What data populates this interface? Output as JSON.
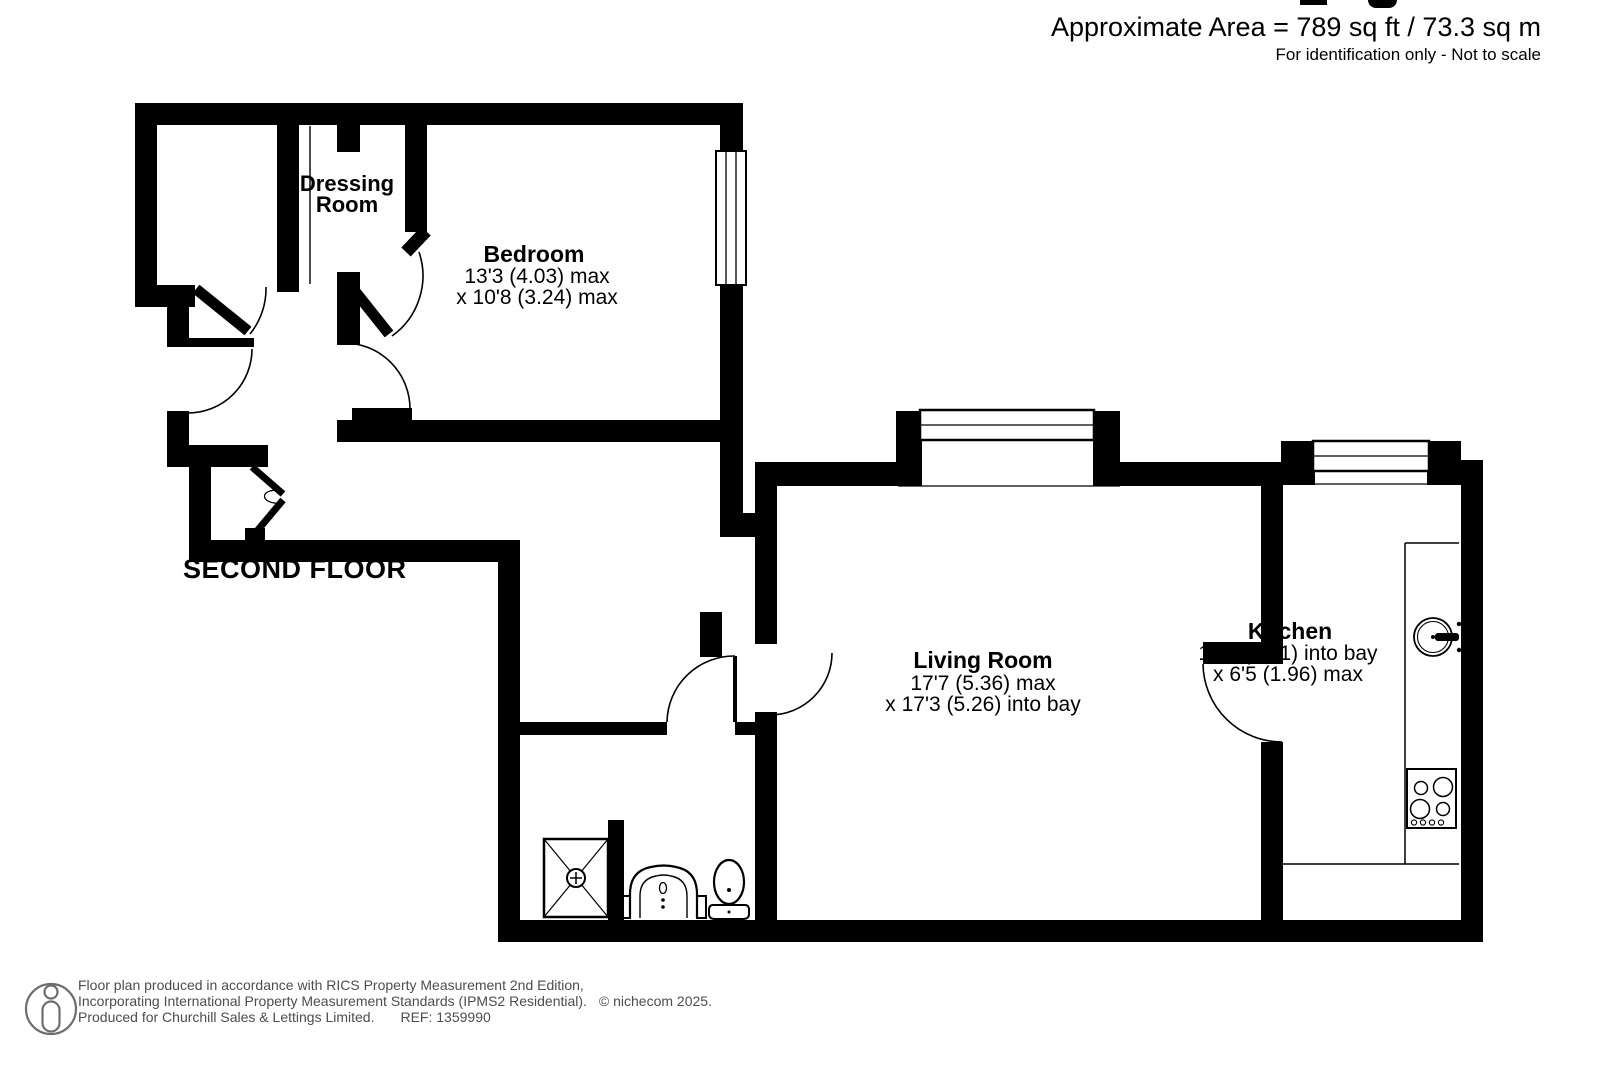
{
  "page": {
    "area_line": "Approximate Area = 789 sq ft / 73.3 sq m",
    "identification_line": "For identification only - Not to scale"
  },
  "plan": {
    "floor_label": "SECOND FLOOR",
    "rooms": {
      "dressing_room": {
        "line1": "Dressing",
        "line2": "Room"
      },
      "bedroom": {
        "name": "Bedroom",
        "dim1": "13'3 (4.03) max",
        "dim2": "x 10'8 (3.24) max"
      },
      "living_room": {
        "name": "Living Room",
        "dim1": "17'7 (5.36) max",
        "dim2": "x 17'3 (5.26) into bay"
      },
      "kitchen": {
        "name": "Kitchen",
        "dim1": "16'1 (4.91) into bay",
        "dim2": "x 6'5 (1.96) max"
      }
    },
    "fixtures": [
      "shower-tray",
      "wash-basin",
      "toilet",
      "kitchen-sink",
      "hob",
      "kitchen-counter"
    ],
    "features": [
      "bay-windows",
      "door-swing-arcs",
      "bifold-cupboard-door"
    ]
  },
  "footer": {
    "line1": "Floor plan produced in accordance with RICS Property Measurement 2nd Edition,",
    "line2": "Incorporating International Property Measurement Standards (IPMS2 Residential).",
    "copyright": "© nichecom 2025.",
    "line3": "Produced for Churchill Sales & Lettings Limited.",
    "ref": "REF: 1359990"
  },
  "colors": {
    "wall": "#000000",
    "text": "#000000",
    "footer_text": "#4d4d4d",
    "background": "#ffffff"
  }
}
